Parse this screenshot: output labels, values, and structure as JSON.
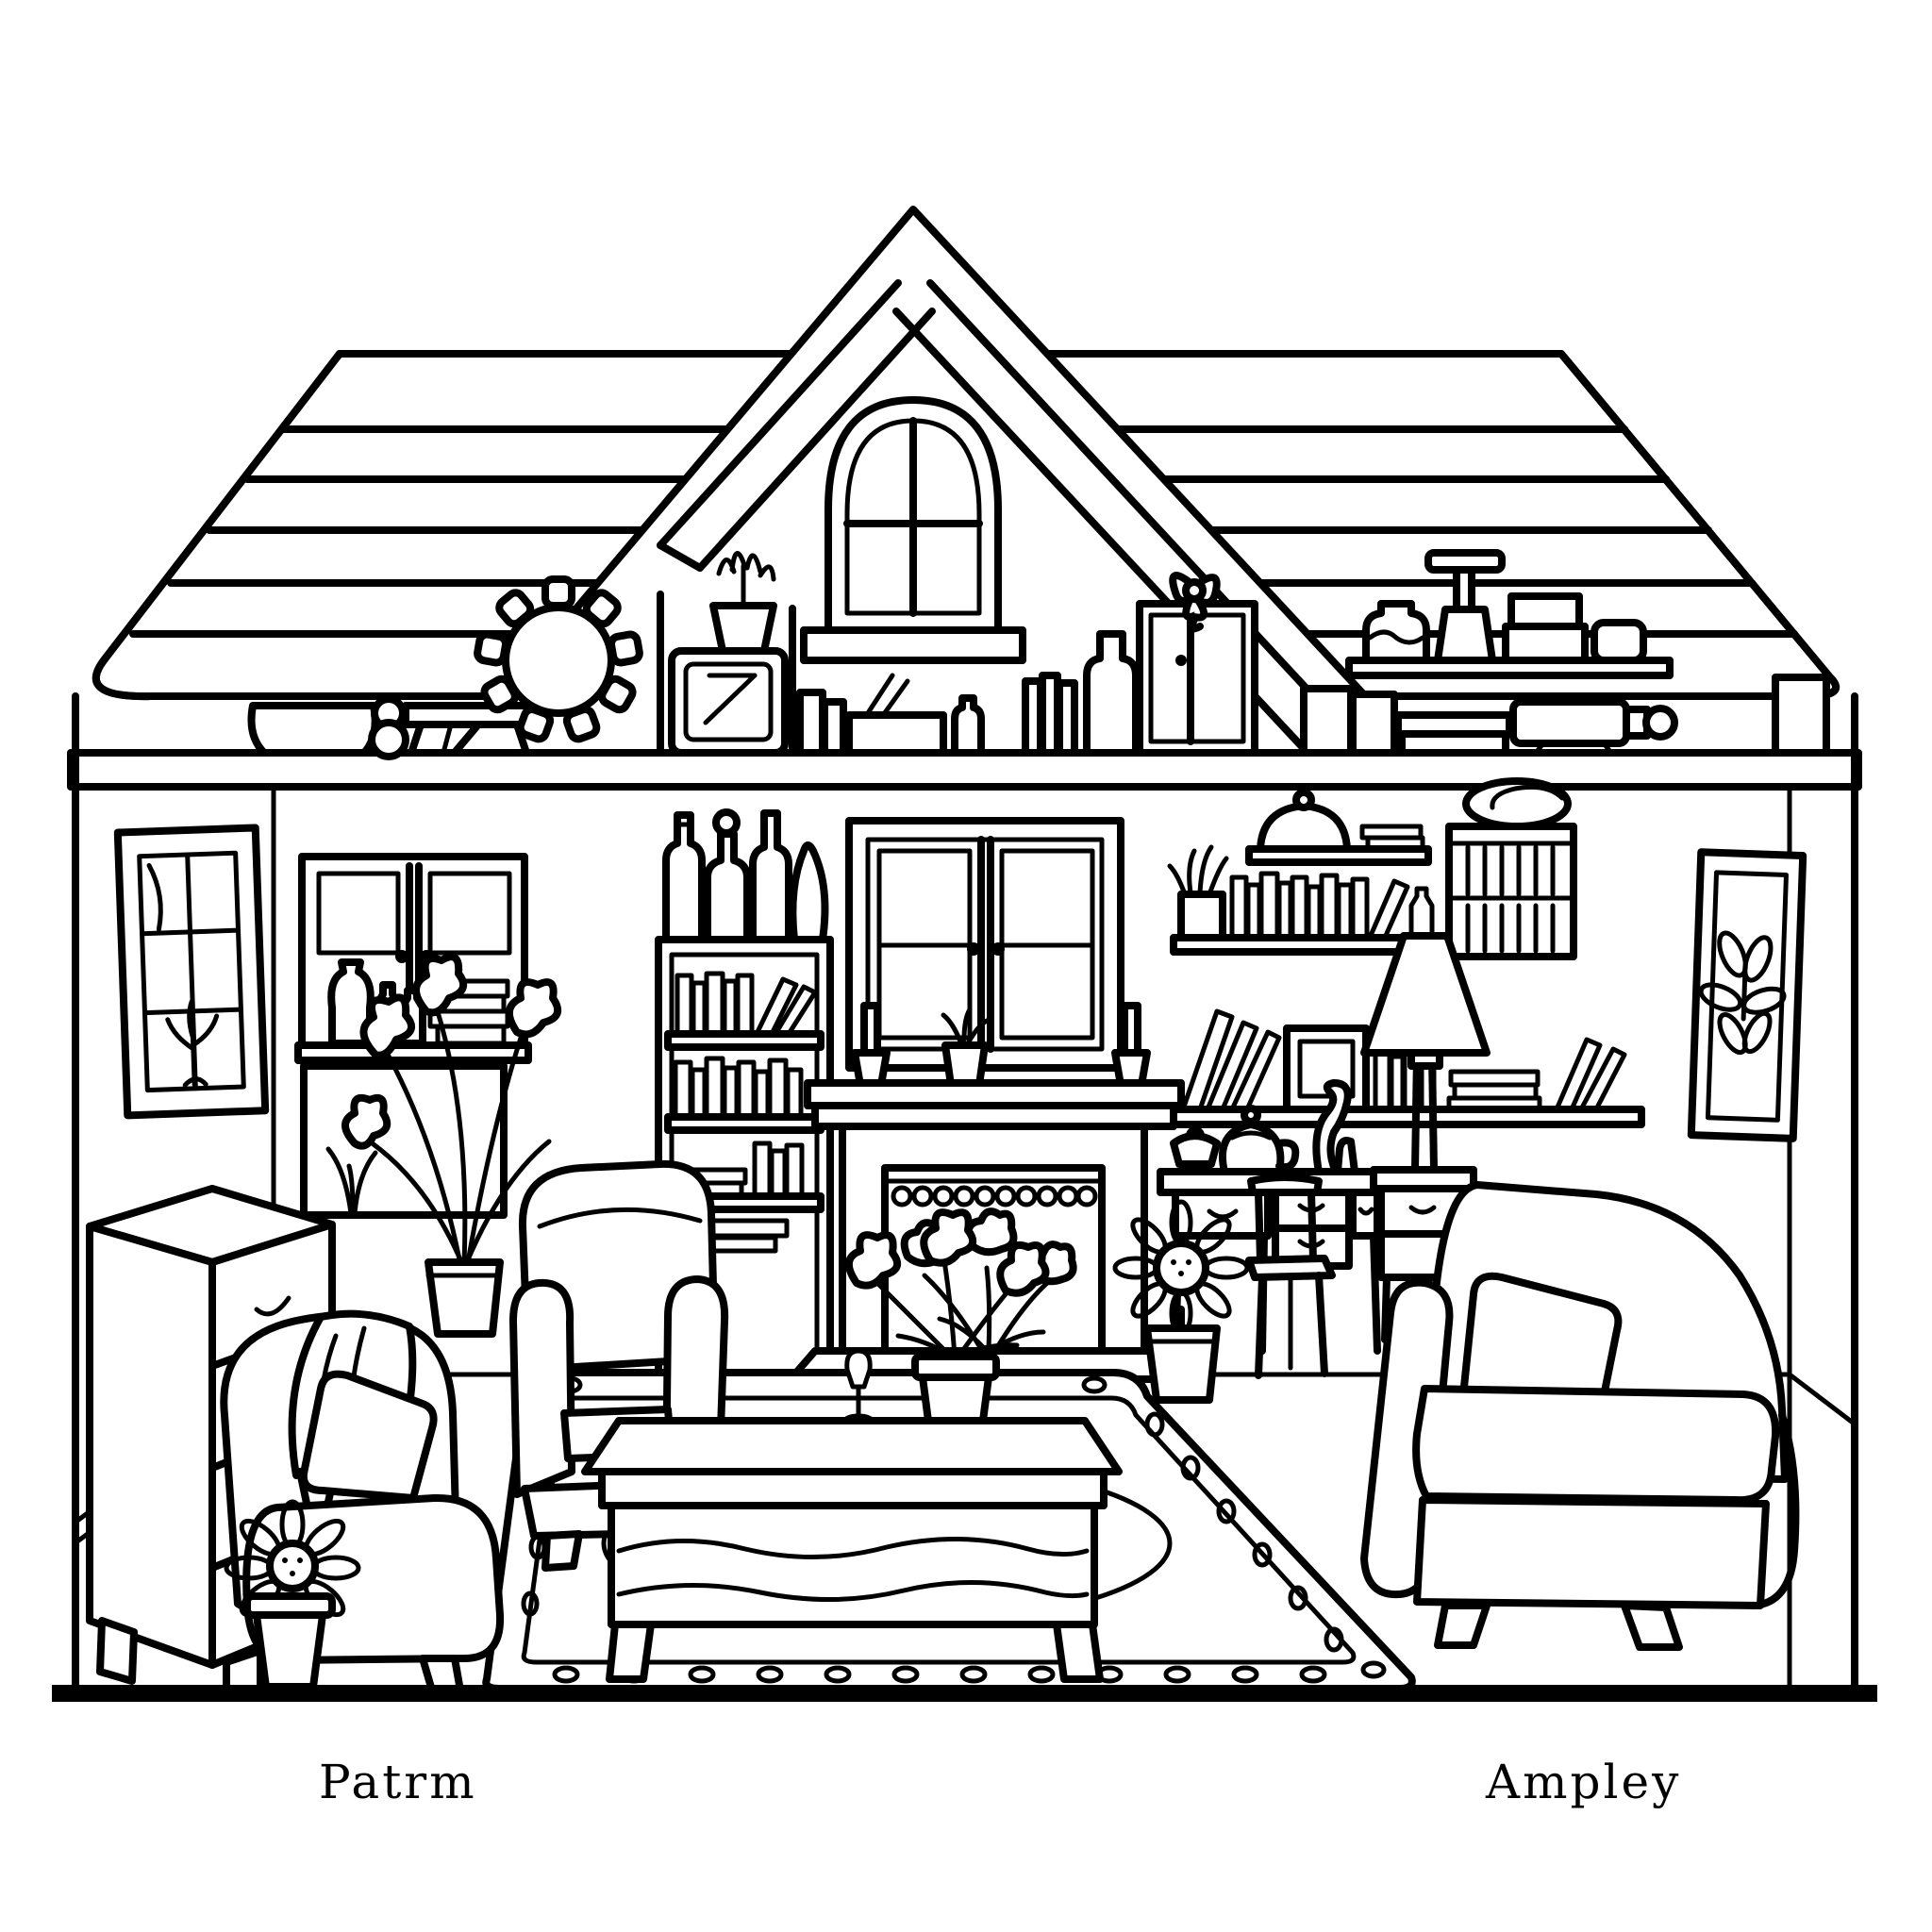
{
  "captions": {
    "left": "Patrm",
    "right": "Ampley"
  },
  "palette": {
    "ink": "#000000",
    "paper": "#ffffff"
  },
  "scene": {
    "style": "black outline coloring-page drawing",
    "subject": "dollhouse cross-section of a living room with attic shelf",
    "objects": [
      "shingled roof",
      "gable with arched window",
      "attic shelf with bowl, gear, mirror stand, potted plant, books, pencil box, jug, wardrobe with bow, honey jar, stamp, boxes, telescope",
      "left wall framed window with plant",
      "glass-door cabinet with vases and books",
      "tall iris plant",
      "bookcase with bottles on top",
      "window over fireplace mantel with candlesticks",
      "fireplace with scalloped trim and flowers",
      "wall shelves with books, cloche and photo frame",
      "slatted hutch",
      "table lamp",
      "desk with teapot, lidded bowl and cat figurine",
      "desk chair",
      "side table",
      "sunflower in pot",
      "chest of drawers",
      "potted daisy",
      "armchair with blanket and pillow",
      "small armchair",
      "coffee table with goblet and flower pot",
      "oval-border rug",
      "sofa with pillow"
    ]
  }
}
